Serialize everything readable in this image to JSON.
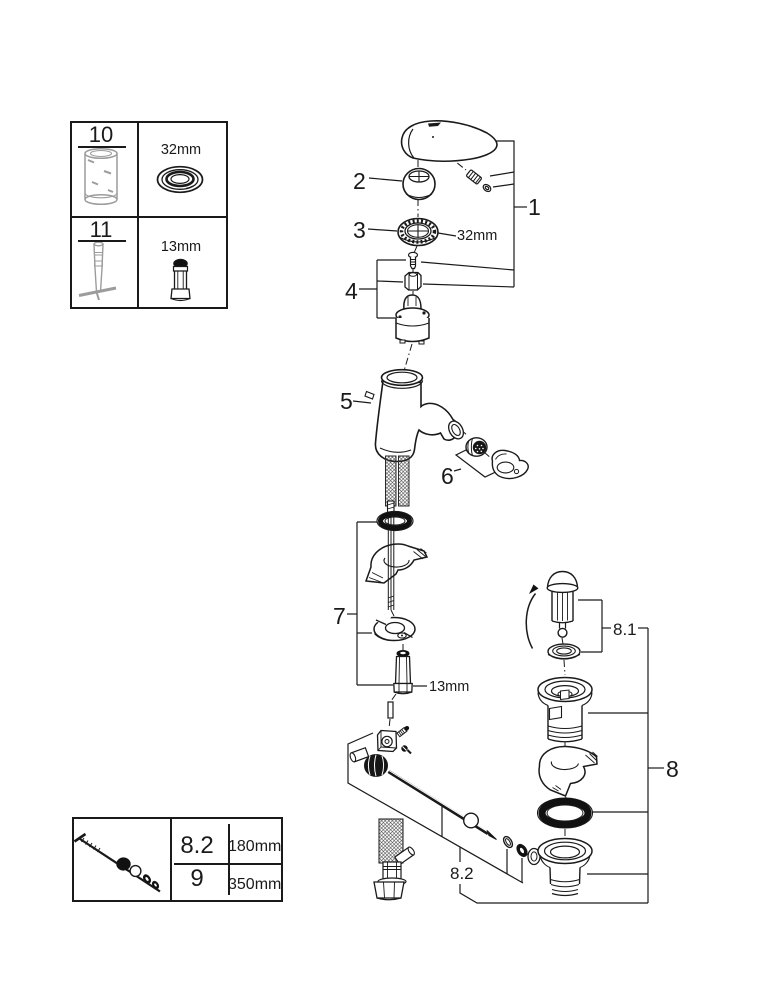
{
  "title": "Faucet exploded-parts diagram",
  "legend_top": {
    "rows": [
      {
        "number": "10",
        "size": "32mm"
      },
      {
        "number": "11",
        "size": "13mm"
      }
    ]
  },
  "legend_bottom": {
    "rows": [
      {
        "number": "8.2",
        "length": "180mm"
      },
      {
        "number": "9",
        "length": "350mm"
      }
    ]
  },
  "callouts": {
    "c1": "1",
    "c2": "2",
    "c3": "3",
    "c4": "4",
    "c5": "5",
    "c6": "6",
    "c7": "7",
    "c8": "8",
    "c8_1": "8.1",
    "c8_2": "8.2",
    "size_32mm": "32mm",
    "size_13mm": "13mm"
  },
  "colors": {
    "ink": "#1a1a1a",
    "tool_gray": "#9c9c9c",
    "paper": "#ffffff"
  }
}
